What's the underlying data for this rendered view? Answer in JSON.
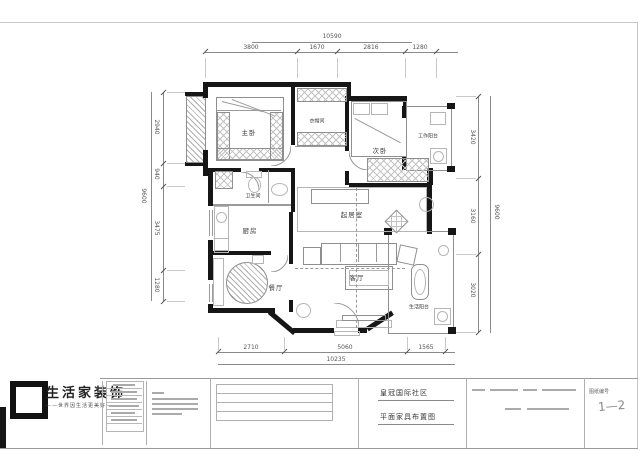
{
  "drawing": {
    "rooms": {
      "master": "主卧",
      "cloakroom": "衣帽间",
      "second_bedroom": "次卧",
      "work_balcony": "工作阳台",
      "bathroom": "卫生间",
      "kitchen": "厨房",
      "dining": "餐厅",
      "sitting": "起居室",
      "living": "客厅",
      "life_balcony": "生活阳台"
    },
    "dimensions": {
      "top": {
        "total": "10590",
        "segments": [
          "3800",
          "1670",
          "2816",
          "1280"
        ]
      },
      "bottom": {
        "total": "10235",
        "segments": [
          "2710",
          "5060",
          "1565"
        ]
      },
      "left": {
        "total": "9600",
        "segments": [
          "2940",
          "940",
          "3475",
          "1280"
        ]
      },
      "right": {
        "total": "9600",
        "segments": [
          "3420",
          "3160",
          "3020"
        ]
      }
    }
  },
  "titleblock": {
    "brand": "生活家装饰",
    "brand_tagline": "——世界因生活更美好——",
    "project_name": "皇冠国际社区",
    "drawing_title": "平面家具布置图",
    "sheet_label": "图纸编号",
    "sheet_number": "1—2"
  }
}
